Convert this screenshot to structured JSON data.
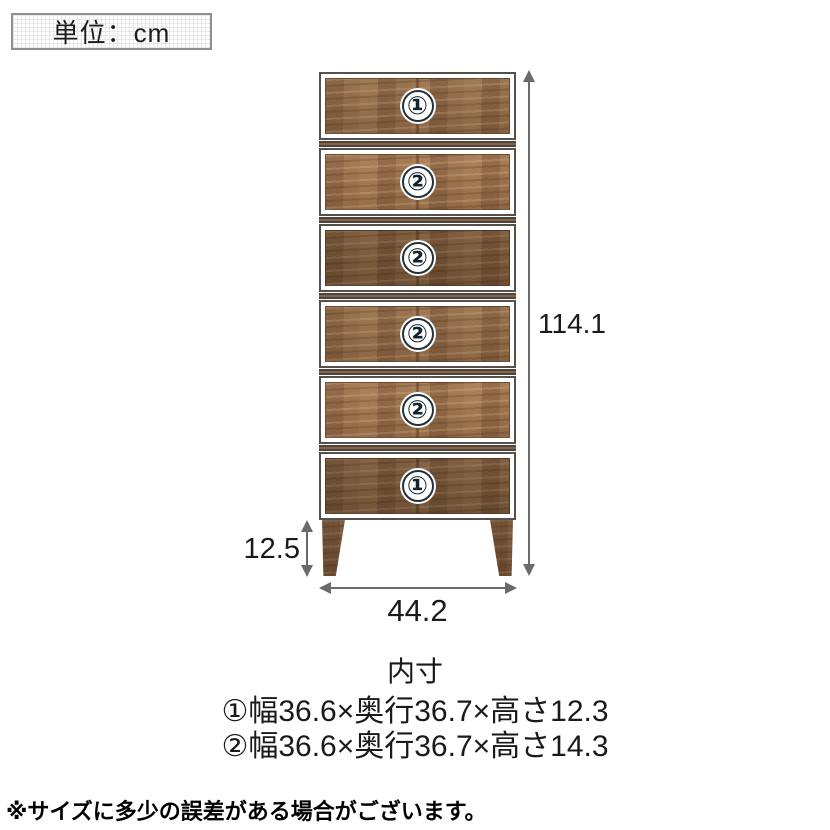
{
  "unit_label": "単位：cm",
  "diagram": {
    "drawers": [
      {
        "badge": "①"
      },
      {
        "badge": "②"
      },
      {
        "badge": "②"
      },
      {
        "badge": "②"
      },
      {
        "badge": "②"
      },
      {
        "badge": "①"
      }
    ],
    "dimensions": {
      "total_height": "114.1",
      "leg_height": "12.5",
      "width": "44.2"
    }
  },
  "specs": {
    "title": "内寸",
    "lines": [
      "①幅36.6×奥行36.7×高さ12.3",
      "②幅36.6×奥行36.7×高さ14.3"
    ]
  },
  "note": "※サイズに多少の誤差がある場合がございます。",
  "colors": {
    "wood_base": "#8d6848",
    "outline": "#55504a",
    "arrow": "#6a6a6a",
    "text": "#1a1a1a"
  }
}
